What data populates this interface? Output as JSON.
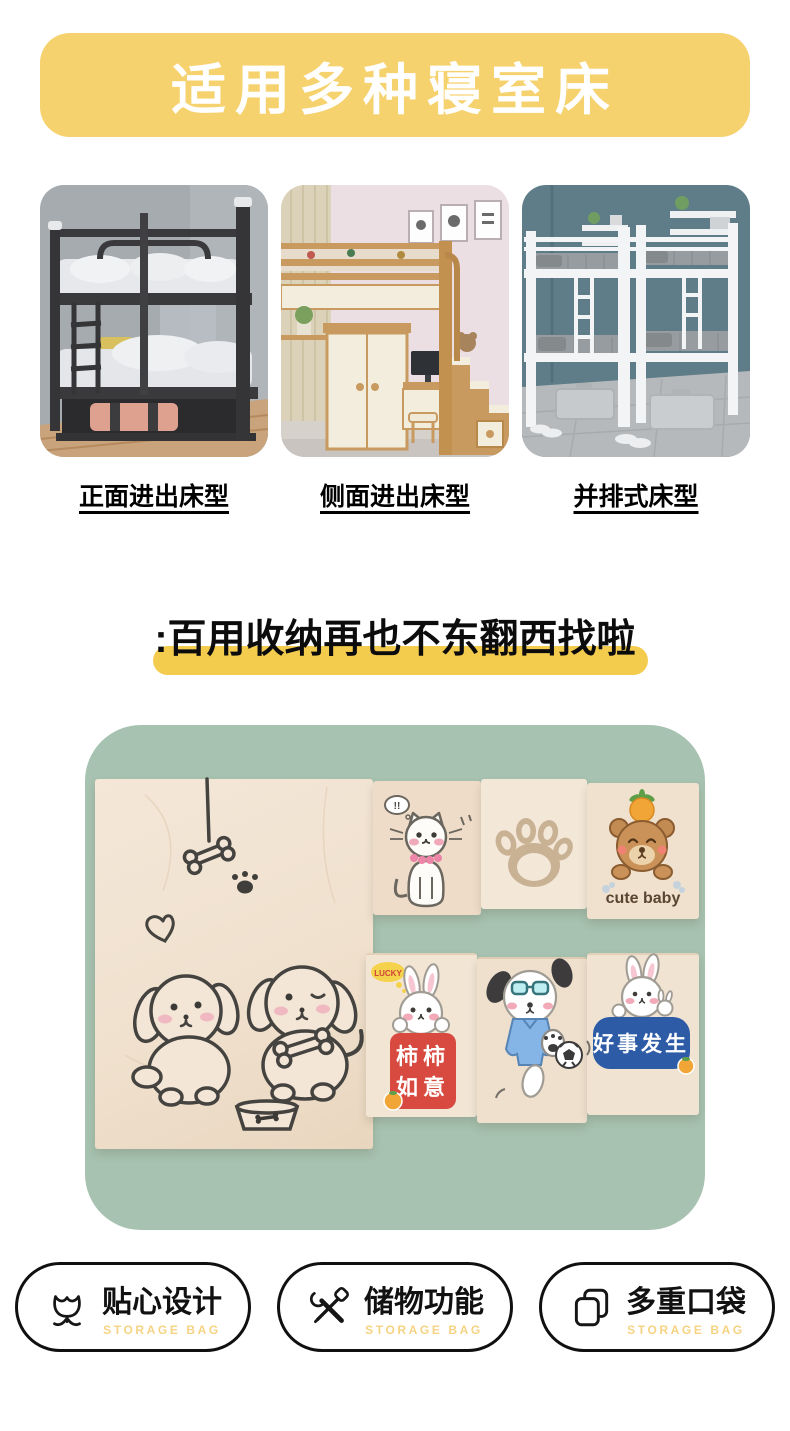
{
  "banner": {
    "title": "适用多种寝室床",
    "bg": "#F6D26E"
  },
  "bed_types": [
    {
      "label": "正面进出床型"
    },
    {
      "label": "侧面进出床型"
    },
    {
      "label": "并排式床型"
    }
  ],
  "headline": {
    "text": ":百用收纳再也不东翻西找啦",
    "highlight_color": "#F3CC4E"
  },
  "showcase": {
    "bg": "#A7C2B0",
    "bag": {
      "cat_bubble": "!!",
      "cute_baby": "cute baby",
      "lucky": "LUCKY",
      "red_label_line1": "柿柿",
      "red_label_line2": "如意",
      "blue_label": "好事发生"
    },
    "colors": {
      "bag_beige": "#F0E2D0",
      "label_red": "#D8493F",
      "label_blue": "#2E5BA6"
    }
  },
  "features": [
    {
      "icon": "tulip-icon",
      "label": "贴心设计",
      "sublabel": "STORAGE BAG"
    },
    {
      "icon": "tools-icon",
      "label": "储物功能",
      "sublabel": "STORAGE BAG"
    },
    {
      "icon": "stacked-pockets-icon",
      "label": "多重口袋",
      "sublabel": "STORAGE BAG"
    }
  ]
}
